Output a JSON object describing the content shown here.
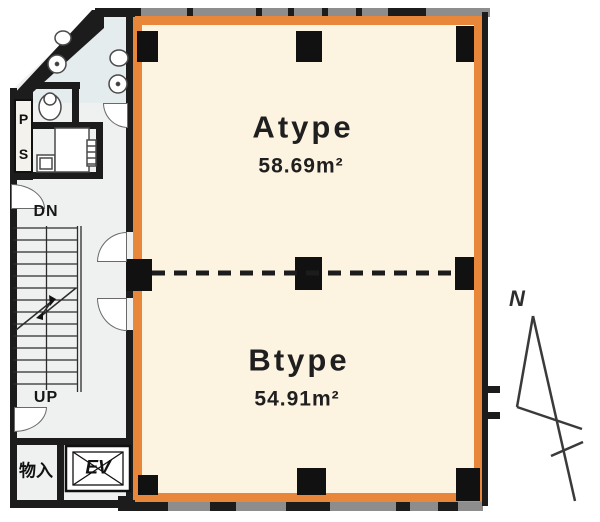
{
  "plan": {
    "type": "building-floor-plan",
    "units": [
      {
        "name": "Atype",
        "area": "58.69m²"
      },
      {
        "name": "Btype",
        "area": "54.91m²"
      }
    ],
    "labels": {
      "stairs_down": "DN",
      "stairs_up": "UP",
      "storage": "物入",
      "elevator": "EV",
      "pipe_space_p": "P",
      "pipe_space_s": "S",
      "north": "N"
    },
    "colors": {
      "unit_outline_orange": "#E8873A",
      "unit_floor_cream": "#FCF4E1",
      "common_floor_gray": "#EEF1F0",
      "wet_area_blue_gray": "#E4ECEE",
      "wall_black": "#1C1C1C",
      "band_gray": "#8D8D8D"
    }
  }
}
